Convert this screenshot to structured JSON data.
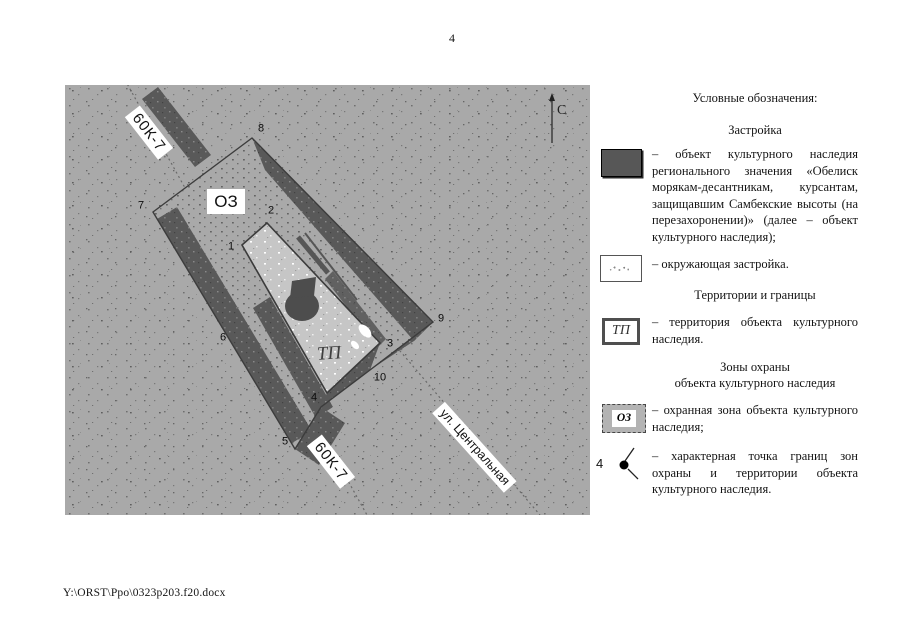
{
  "page": {
    "number": "4",
    "footer_path": "Y:\\ORST\\Ppo\\0323p203.f20.docx"
  },
  "map": {
    "north_label": "С",
    "road_label_1": "60К-7",
    "road_label_2": "60К-7",
    "street_label": "ул. Центральная",
    "zone_label": "ОЗ",
    "territory_label": "ТП",
    "points": [
      "1",
      "2",
      "3",
      "4",
      "5",
      "6",
      "7",
      "8",
      "9",
      "10"
    ]
  },
  "legend": {
    "title": "Условные обозначения:",
    "buildings_heading": "Застройка",
    "object_item_text": "– объект культурного наследия регионального значения «Обелиск морякам-десантникам, курсантам, защищавшим Самбекские высоты (на перезахоронении)» (далее – объект культурного наследия);",
    "surrounding_item_text": "– окружающая застройка.",
    "territories_heading": "Территории и границы",
    "territory_item_text": "– территория объекта культурного наследия.",
    "zones_heading_line1": "Зоны охраны",
    "zones_heading_line2": "объекта культурного наследия",
    "zone_item_text": "– охранная зона объекта культурного наследия;",
    "point_item_text": "– характерная точка границ зон охраны и территории объекта культурного наследия.",
    "tp_swatch_label": "ТП",
    "oz_swatch_label": "ОЗ",
    "point_swatch_number": "4"
  },
  "colors": {
    "map_background": "#a9a9a9",
    "dark_band": "#595959",
    "territory_fill": "#c6c6c6",
    "object_swatch": "#575757",
    "oz_swatch_fill": "#b3b3b3",
    "boundary_line": "#3c3c3c"
  }
}
